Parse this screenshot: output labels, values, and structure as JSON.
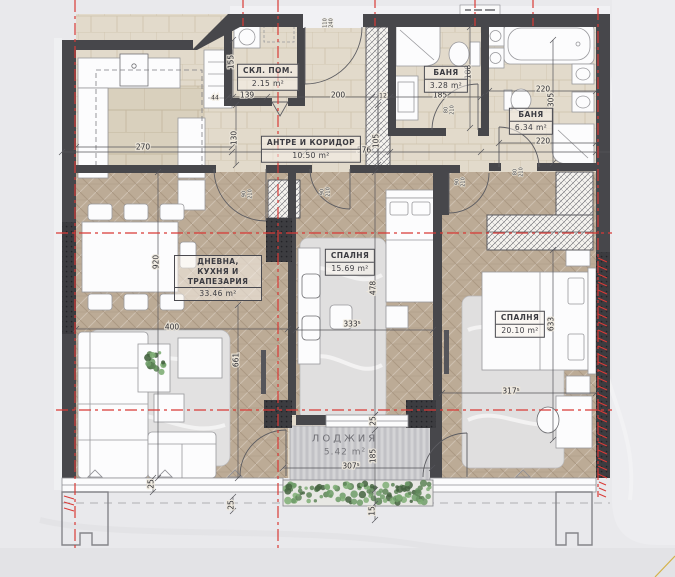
{
  "plan": {
    "type": "apartment-floor-plan",
    "language": "bg",
    "rooms": [
      {
        "id": "storage",
        "name": "СКЛ. ПОМ.",
        "area": "2.15 m²",
        "x": 268,
        "y": 77
      },
      {
        "id": "hallway",
        "name": "АНТРЕ И КОРИДОР",
        "area": "10.50 m²",
        "x": 311,
        "y": 149
      },
      {
        "id": "bath-1",
        "name": "БАНЯ",
        "area": "3.28 m²",
        "x": 446,
        "y": 79
      },
      {
        "id": "bath-2",
        "name": "БАНЯ",
        "area": "6.34 m²",
        "x": 531,
        "y": 121
      },
      {
        "id": "living-kitchen",
        "name": "ДНЕВНА, КУХНЯ И ТРАПЕЗАРИЯ",
        "area": "33.46 m²",
        "x": 218,
        "y": 278
      },
      {
        "id": "bedroom-1",
        "name": "СПАЛНЯ",
        "area": "15.69 m²",
        "x": 350,
        "y": 262
      },
      {
        "id": "bedroom-2",
        "name": "СПАЛНЯ",
        "area": "20.10 m²",
        "x": 520,
        "y": 324
      },
      {
        "id": "loggia",
        "name": "ЛОДЖИЯ",
        "area": "5.42 m²",
        "x": 345,
        "y": 446
      }
    ],
    "dimensions": [
      {
        "t": "270",
        "x": 143,
        "y": 147,
        "r": 0
      },
      {
        "t": "139",
        "x": 247,
        "y": 95,
        "r": 0
      },
      {
        "t": "200",
        "x": 338,
        "y": 95,
        "r": 0
      },
      {
        "t": "12",
        "x": 383,
        "y": 95,
        "r": 0,
        "small": true
      },
      {
        "t": "185",
        "x": 440,
        "y": 95,
        "r": 0
      },
      {
        "t": "220",
        "x": 543,
        "y": 89,
        "r": 0
      },
      {
        "t": "220",
        "x": 543,
        "y": 141,
        "r": 0
      },
      {
        "t": "576",
        "x": 364,
        "y": 150,
        "r": 0
      },
      {
        "t": "44",
        "x": 215,
        "y": 97,
        "r": 0,
        "small": true
      },
      {
        "t": "400",
        "x": 172,
        "y": 327,
        "r": 0
      },
      {
        "t": "333⁵",
        "x": 352,
        "y": 324,
        "r": 0
      },
      {
        "t": "317⁵",
        "x": 511,
        "y": 391,
        "r": 0
      },
      {
        "t": "307⁵",
        "x": 351,
        "y": 466,
        "r": 0
      },
      {
        "t": "155",
        "x": 231,
        "y": 62,
        "r": 1
      },
      {
        "t": "130",
        "x": 234,
        "y": 138,
        "r": 1
      },
      {
        "t": "105",
        "x": 376,
        "y": 141,
        "r": 1
      },
      {
        "t": "188",
        "x": 468,
        "y": 72,
        "r": 1
      },
      {
        "t": "305",
        "x": 551,
        "y": 100,
        "r": 1
      },
      {
        "t": "920",
        "x": 156,
        "y": 262,
        "r": 1
      },
      {
        "t": "661",
        "x": 236,
        "y": 360,
        "r": 1
      },
      {
        "t": "478",
        "x": 373,
        "y": 288,
        "r": 1
      },
      {
        "t": "633",
        "x": 551,
        "y": 324,
        "r": 1
      },
      {
        "t": "25",
        "x": 373,
        "y": 421,
        "r": 1
      },
      {
        "t": "185",
        "x": 373,
        "y": 456,
        "r": 1
      },
      {
        "t": "15",
        "x": 372,
        "y": 511,
        "r": 1
      },
      {
        "t": "25",
        "x": 151,
        "y": 484,
        "r": 1
      },
      {
        "t": "25",
        "x": 231,
        "y": 505,
        "r": 1
      }
    ],
    "door_marks": [
      {
        "a": "110",
        "b": "240",
        "x": 328,
        "y": 23
      },
      {
        "a": "80",
        "b": "210",
        "x": 449,
        "y": 110
      },
      {
        "a": "80",
        "b": "210",
        "x": 518,
        "y": 172
      },
      {
        "a": "90",
        "b": "210",
        "x": 460,
        "y": 182
      },
      {
        "a": "90",
        "b": "210",
        "x": 247,
        "y": 194
      },
      {
        "a": "90",
        "b": "210",
        "x": 325,
        "y": 192
      }
    ],
    "colors": {
      "wall": "#47474b",
      "wall_dark": "#3c3c40",
      "axis_red": "#d93a36",
      "tile_floor": "#e2dacb",
      "wood_floor": "#bcab96",
      "deck": "#cbcbce",
      "furniture": "#fcfcfd",
      "greenery": "#5d8457",
      "background": "#e9e9ec"
    }
  }
}
